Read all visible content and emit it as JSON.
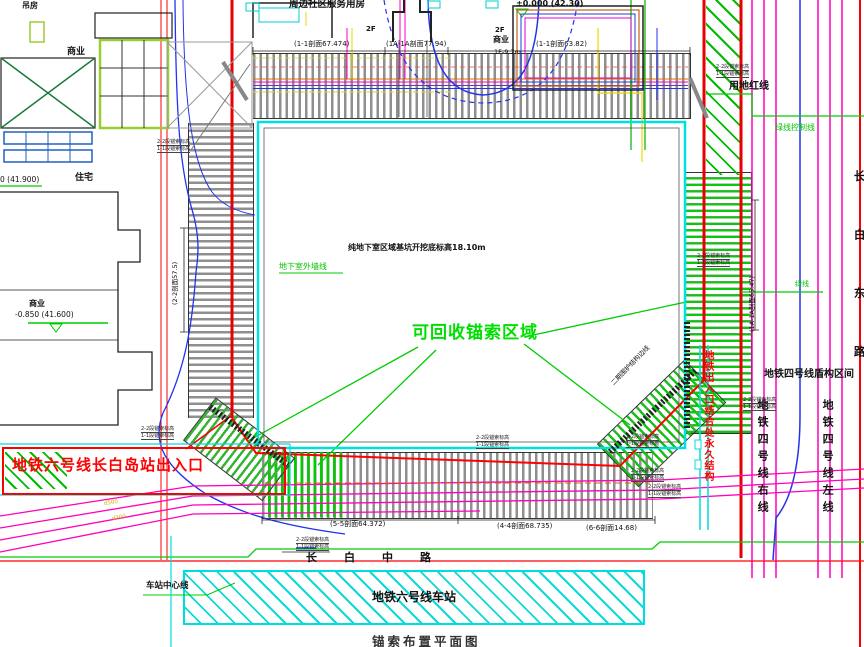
{
  "title": "锚索布置平面图",
  "palette": {
    "boundary_red": "#ff0000",
    "metro_magenta": "#ff00bb",
    "basement_cyan": "#00dddd",
    "anchor_green": "#00cc00",
    "pipeline_blue": "#2233ee",
    "utility_yellow": "#e8d800",
    "anchor_bar_gray": "#8f8f8f"
  },
  "top": {
    "community_label": "周边社区服务用房",
    "elev_ne": "±0.000 (42.30)",
    "sec1": "(1-1剖面67.474)",
    "sec2": "(1A-1A剖面77.94)",
    "sec3": "(1-1剖面63.82)",
    "f2a": "2F",
    "f2b": "2F",
    "shangye": "商业",
    "f1": "1F-9.7m"
  },
  "left": {
    "small_house": "吊房",
    "shangye1": "商业",
    "zhuzhai": "住宅",
    "elev_w": "0 (41.900)",
    "shangye2": "商业",
    "elev_sw": "-0.850 (41.600)"
  },
  "pit": {
    "note": "纯地下室区域基坑开挖底标高18.10m",
    "wall_line": "地下室外墙线",
    "anchor_zone": "可回收锚索区域",
    "sec_left": "(2-2剖面57.5)",
    "sec_right": "(1A-1A剖面65.47)",
    "sec_b1": "(5-5剖面64.372)",
    "sec_b2": "(4-4剖面68.735)",
    "sec_b3": "(6-6剖面14.68)",
    "ne_diag_note": "二期围护结构边线",
    "exit_struct_note": "地铁出入口结合处永久结构"
  },
  "right": {
    "red_line": "用地红线",
    "green_line": "绿线控制线",
    "green_line2": "绿线",
    "shield": "地铁四号线盾构区间",
    "line4_right": "地铁四号线右线",
    "line4_left": "地铁四号线左线",
    "road": "长白东路"
  },
  "bottom": {
    "exit": "地铁六号线长白岛站出入口",
    "station": "地铁六号线车站",
    "road": "长白中路",
    "centerline": "车站中心线",
    "pipe1": "d500",
    "pipe2": "d300"
  },
  "tiny_stack": {
    "line1": "2-2段锚索标高",
    "line2": "1-1段锚索标高"
  }
}
